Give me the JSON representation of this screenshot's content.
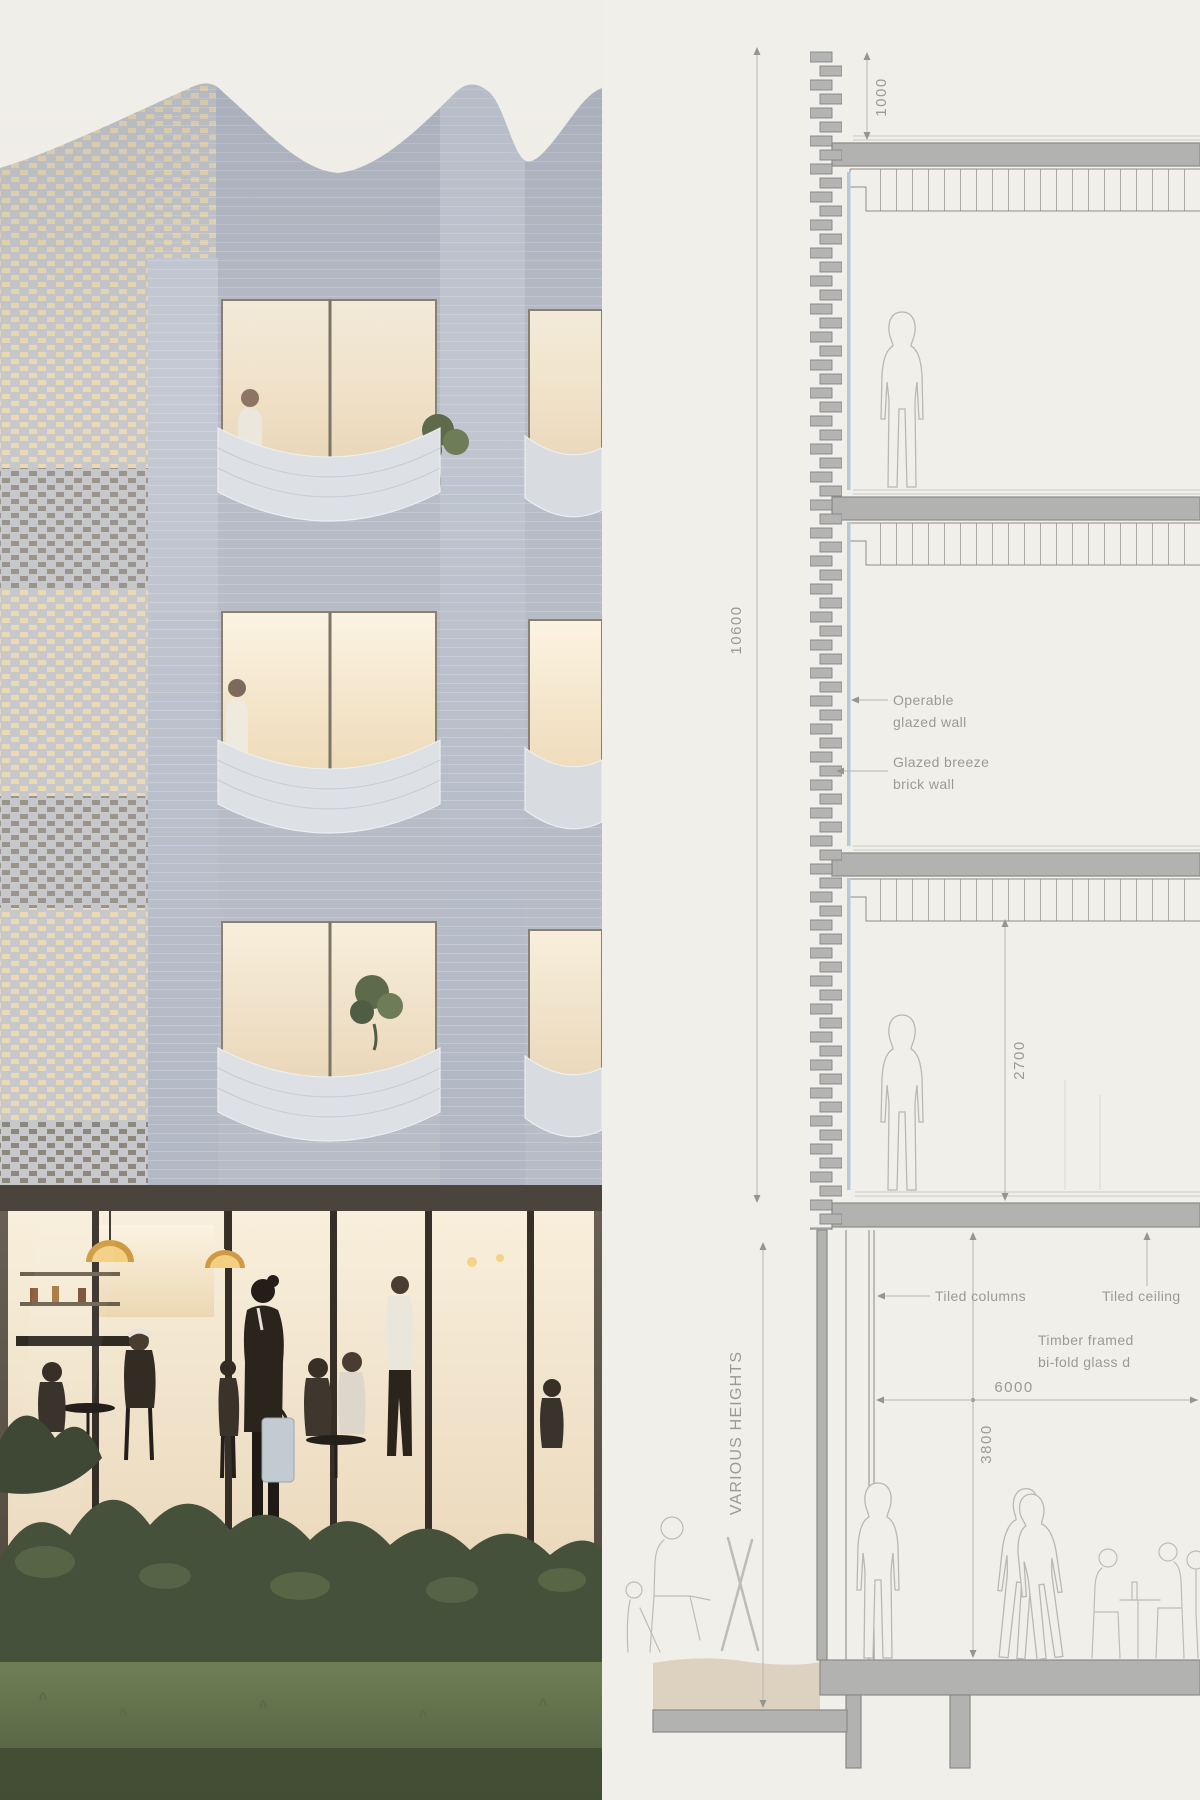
{
  "section": {
    "dimensions": {
      "parapet_height": "1000",
      "facade_overall": "10600",
      "typical_clear_height": "2700",
      "ground_clear_height": "3800",
      "ground_span": "6000"
    },
    "labels": {
      "operable_line1": "Operable",
      "operable_line2": "glazed wall",
      "breeze_line1": "Glazed breeze",
      "breeze_line2": "brick wall",
      "tiled_columns": "Tiled columns",
      "tiled_ceiling": "Tiled ceiling",
      "timber_line1": "Timber framed",
      "timber_line2": "bi-fold glass d",
      "various_heights": "VARIOUS HEIGHTS"
    }
  },
  "palette": {
    "canvas_beige": "#f1efe9",
    "slab_gray": "#b2b2b0",
    "line_gray": "#8b8b89",
    "glazing_blue": "#b3c9da",
    "soil_tan": "#dcd2bf",
    "annotation_gray": "#9c9a92",
    "facade_brick": "#b7bcc7",
    "window_warm": "#f3e6cc",
    "foliage_green": "#46513b",
    "lawn_green": "#66754f"
  }
}
